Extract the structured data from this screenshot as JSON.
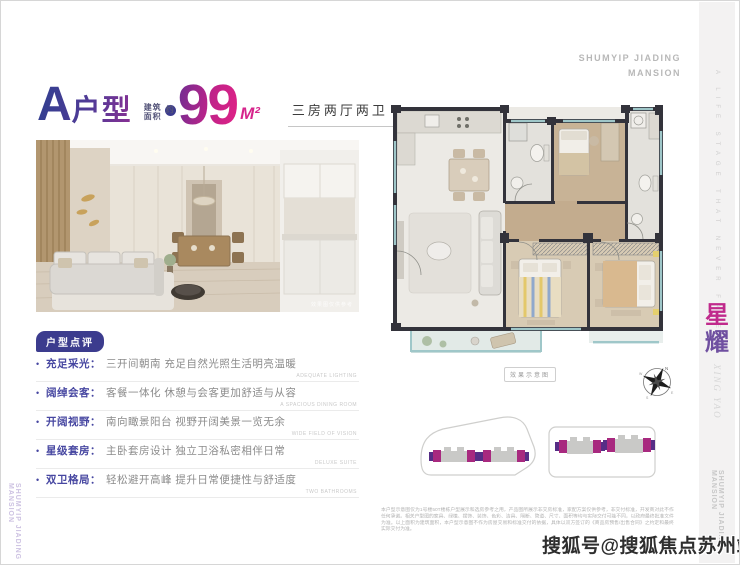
{
  "brand": {
    "top_right_line1": "SHUMYIP JIADING",
    "top_right_line2": "MANSION",
    "side_tagline": "A LIFE STAGE THAT NEVER FADES",
    "side_cn_1": "星",
    "side_cn_2": "耀",
    "side_en": "XING YAO",
    "side_bottom": "SHUMYIP JIADING MANSION",
    "left_bottom": "SHUMYIP JIADING MANSION"
  },
  "header": {
    "unit_letter": "A",
    "unit_word": "户型",
    "area_label_line1": "建筑",
    "area_label_line2": "面积",
    "area_approx_badge": "约",
    "area_value": "99",
    "area_unit": "M²",
    "layout_summary": "三房两厅两卫"
  },
  "photo": {
    "caption": "效果图仅供参考"
  },
  "review": {
    "badge": "户型点评",
    "items": [
      {
        "label": "充足采光：",
        "text": "三开间朝南 充足自然光照生活明亮温暖",
        "en": "ADEQUATE LIGHTING"
      },
      {
        "label": "阔绰会客：",
        "text": "客餐一体化 休憩与会客更加舒适与从容",
        "en": "A SPACIOUS DINING ROOM"
      },
      {
        "label": "开阔视野：",
        "text": "南向瞰景阳台 视野开阔美景一览无余",
        "en": "WIDE FIELD OF VISION"
      },
      {
        "label": "星级套房：",
        "text": "主卧套房设计 独立卫浴私密相伴日常",
        "en": "DELUXE SUITE"
      },
      {
        "label": "双卫格局：",
        "text": "轻松避开高峰 提升日常便捷性与舒适度",
        "en": "TWO BATHROOMS"
      }
    ]
  },
  "floorplan": {
    "caption": "效果示意图"
  },
  "compass": {
    "n": "N",
    "e": "E",
    "s": "S",
    "w": "W"
  },
  "disclaimer": "本户型示意图仅为1号楼50T楼栋户型展示和选房参考之用，产品图所展示非交房标准，家配方案仅供参考，非交付标准，开发商对此不作任何承诺。相关户型图的家具、绿植、摆饰、装饰、色彩、洁具、隔断、管道、尺寸、面积等均与实际交付可能不同，以政府最终批准文件为准。以上面积为建筑面积，本户型示意图不作为房屋交易和标准交付的依据，具体以双方签订的《商品房预售/出售合同》之约定和最终实际交付为准。",
  "watermark": "搜狐号@搜狐焦点苏州站",
  "colors": {
    "accent_magenta": "#d42487",
    "accent_indigo": "#3c3c8e",
    "wall": "#33333b",
    "window_teal": "#9fc7c9"
  }
}
